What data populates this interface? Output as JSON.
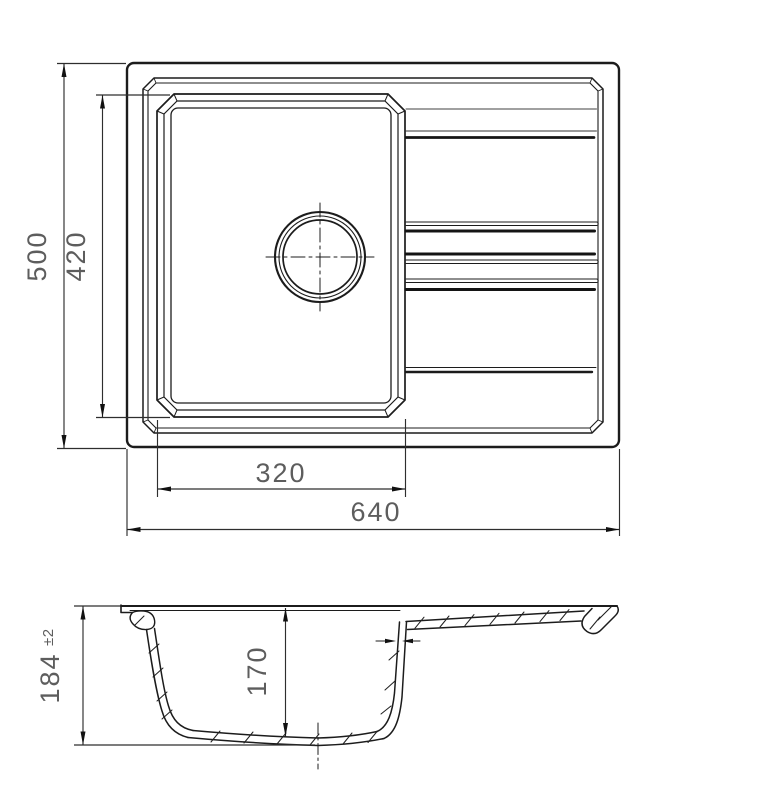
{
  "drawing": {
    "title": "kitchen sink technical drawing",
    "colors": {
      "background": "#ffffff",
      "object_line": "#1c1c1c",
      "dimension_line": "#2e2e2e",
      "dimension_text": "#5d5d5d"
    },
    "plan_view": {
      "label": "top view of sink with bowl, drain and drainboard",
      "dimensions": {
        "overall_width": "640",
        "overall_depth": "500",
        "bowl_width": "320",
        "bowl_depth": "420"
      }
    },
    "section_view": {
      "label": "longitudinal section of sink",
      "dimensions": {
        "overall_height": "184",
        "overall_height_tolerance": "±2",
        "bowl_inner_depth": "170"
      }
    }
  }
}
